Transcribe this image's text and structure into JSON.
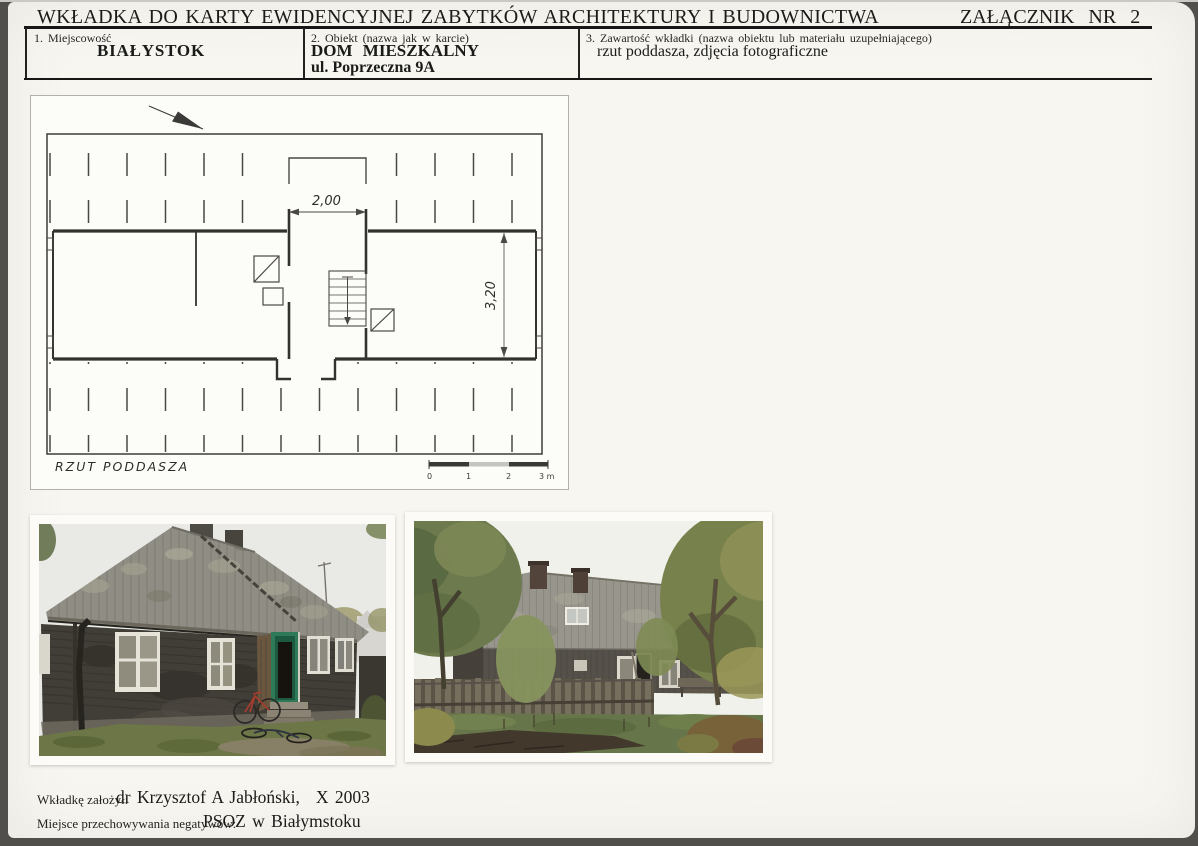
{
  "header": {
    "title": "WKŁADKA DO KARTY EWIDENCYJNEJ ZABYTKÓW ARCHITEKTURY I BUDOWNICTWA",
    "attachment": "ZAŁĄCZNIK NR 2",
    "field1": {
      "label": "1. Miejscowość",
      "value": "BIAŁYSTOK"
    },
    "field2": {
      "label": "2. Obiekt (nazwa jak w karcie)",
      "line1": "DOM MIESZKALNY",
      "line2": "ul. Poprzeczna 9A"
    },
    "field3": {
      "label": "3. Zawartość wkładki (nazwa obiektu lub materiału uzupełniającego)",
      "value": "rzut poddasza, zdjęcia fotograficzne"
    }
  },
  "plan": {
    "caption": "RZUT PODDASZA",
    "dimension_width": "2,00",
    "dimension_depth": "3,20",
    "scale": [
      "0",
      "1",
      "2",
      "3 m"
    ]
  },
  "photos": {
    "left_description": "front elevation: dark wooden house, corrugated roof, green door, bicycles",
    "right_description": "garden elevation: long corrugated roof with chimneys and skylight behind plank fence"
  },
  "footer": {
    "author_label": "Wkładkę założył:",
    "author_value": "dr Krzysztof A Jabłoński,",
    "author_date": "X 2003",
    "negatives_label": "Miejsce przechowywania negatywów:",
    "negatives_value": "PSOZ w Białymstoku"
  },
  "colors": {
    "card": "#f7f6f1",
    "scan_edge": "#514f4b",
    "ink": "#171715",
    "roof_gray": "#908e84",
    "door_green": "#2e7a58"
  }
}
